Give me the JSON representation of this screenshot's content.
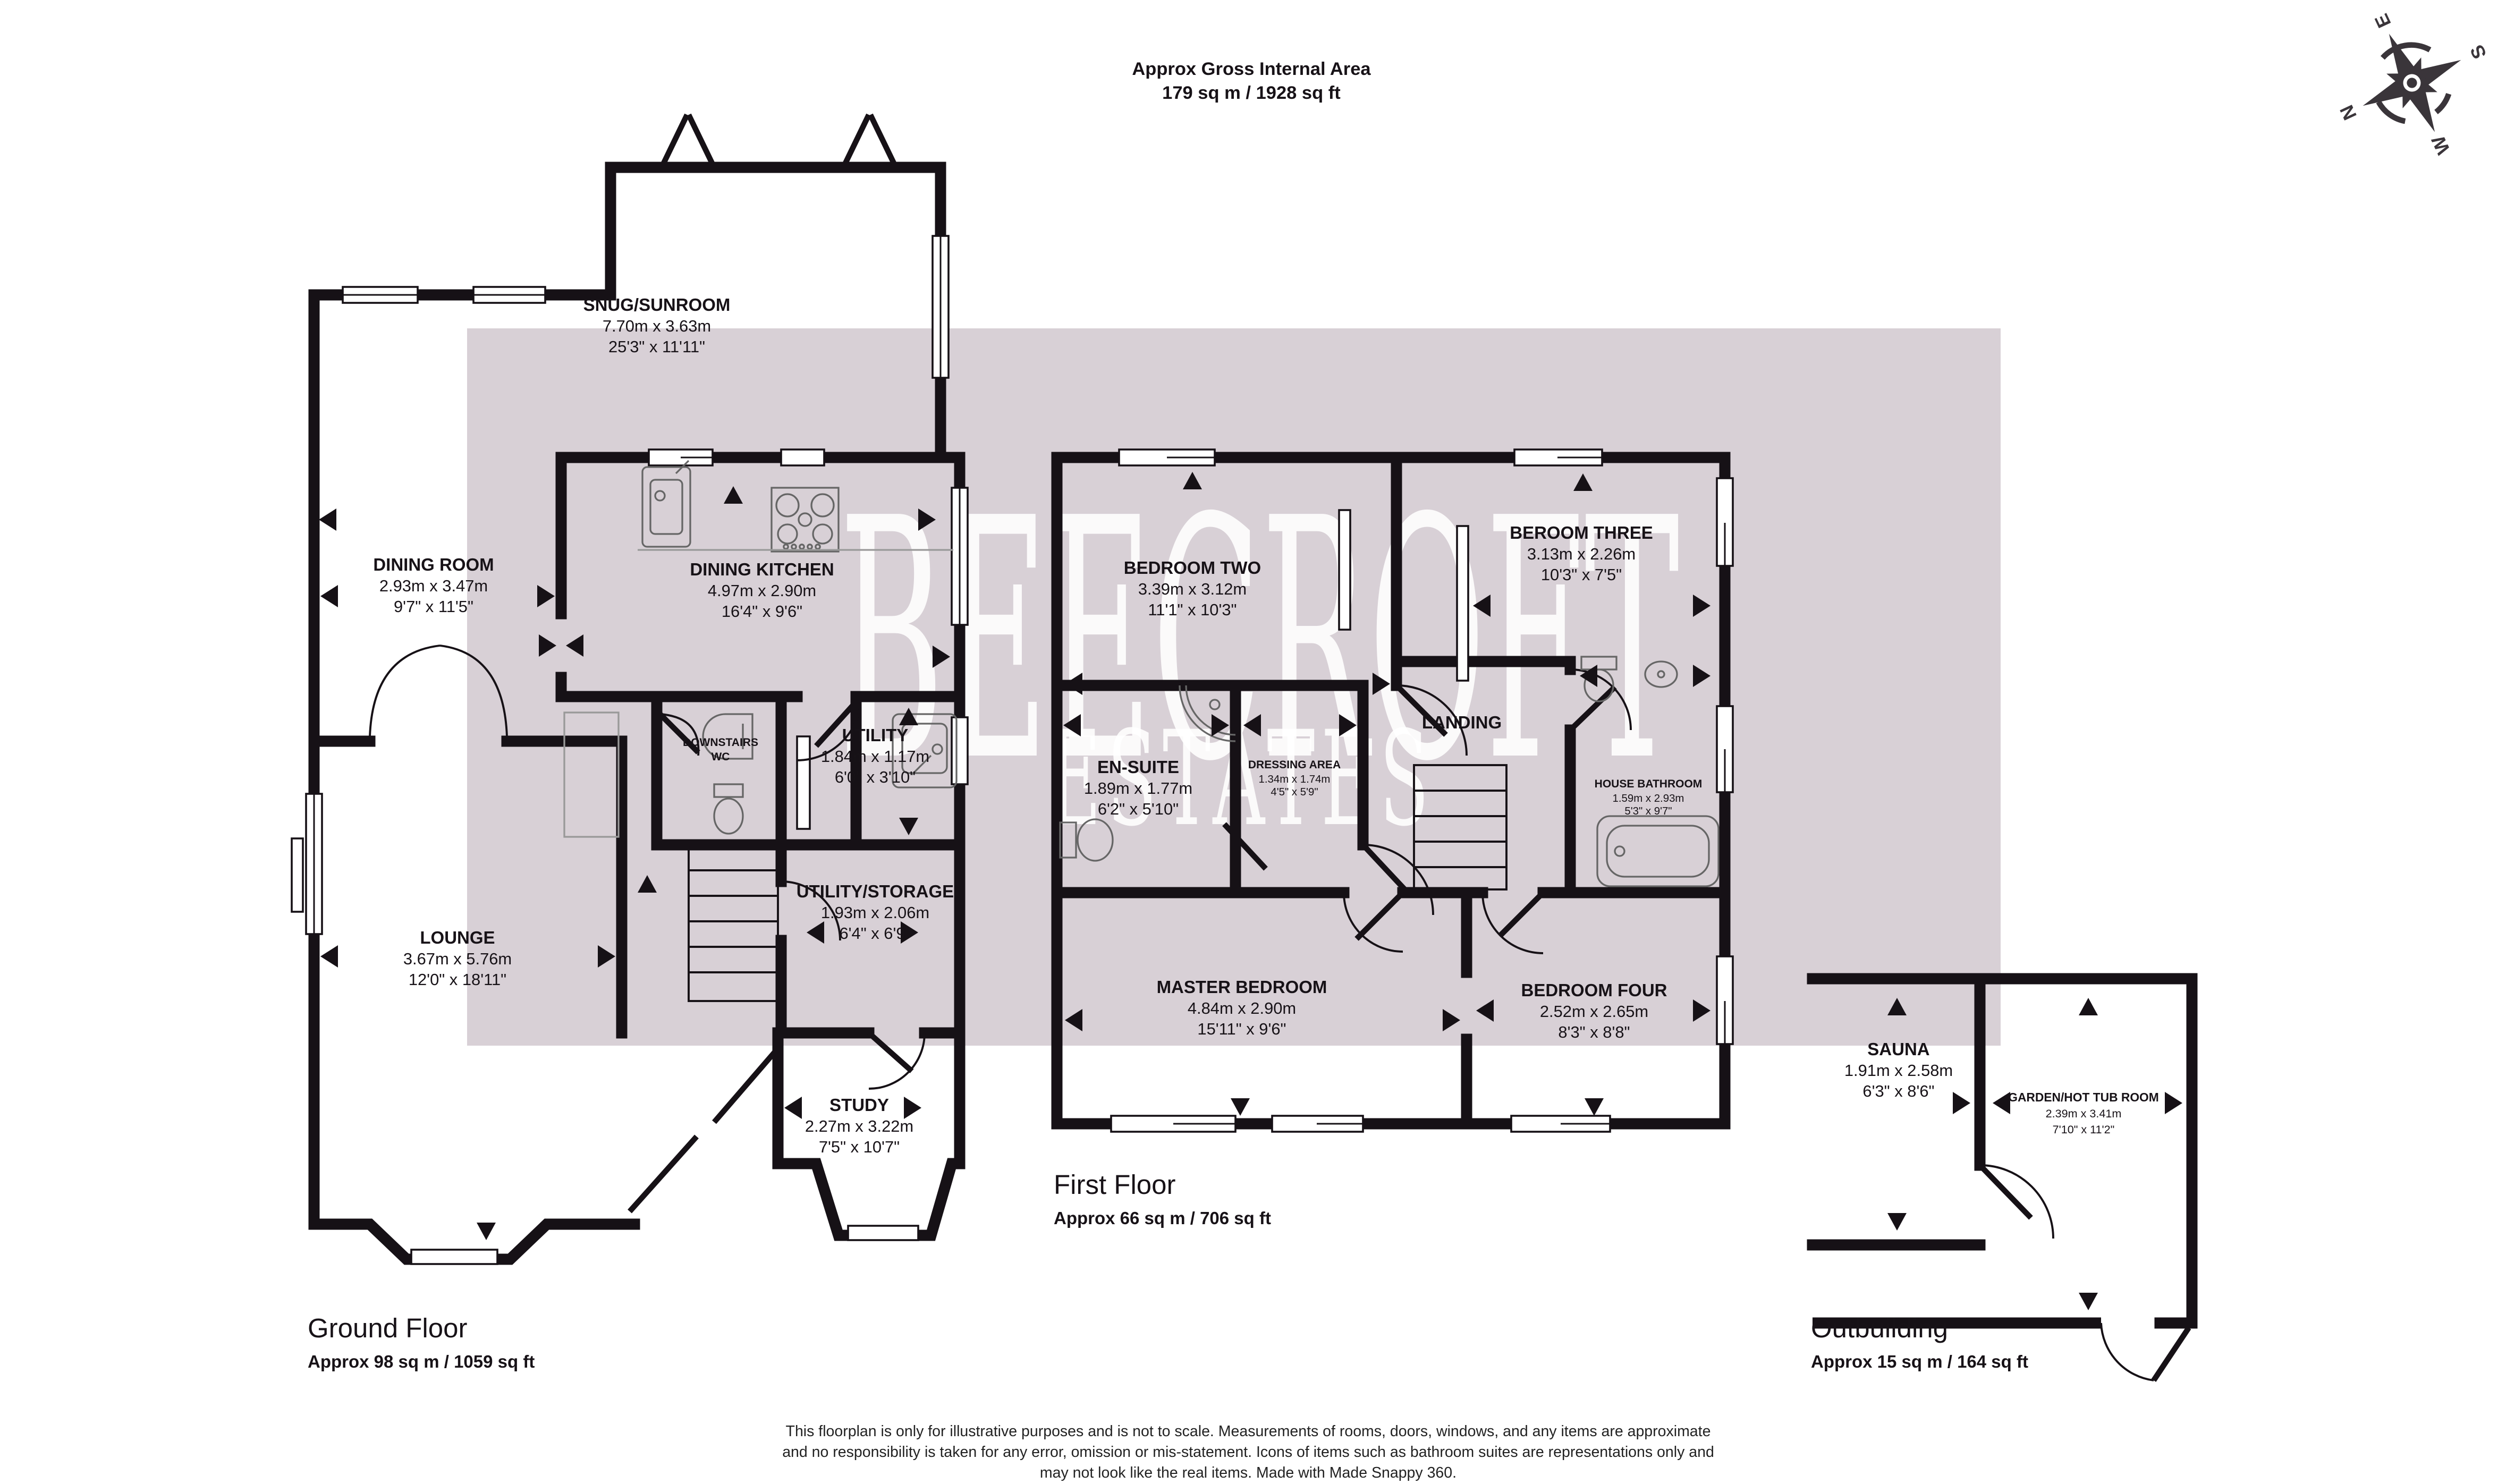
{
  "header": {
    "title": "Approx Gross Internal Area",
    "area": "179 sq m / 1928 sq ft"
  },
  "watermark": {
    "line1": "BEECROFT",
    "line2": "ESTATES"
  },
  "compass": {
    "n": "N",
    "e": "E",
    "s": "S",
    "w": "W"
  },
  "colors": {
    "wall": "#161116",
    "band": "#d8d0d6",
    "fixture": "#666666"
  },
  "floors": {
    "ground": {
      "title": "Ground Floor",
      "area": "Approx 98 sq m / 1059 sq ft",
      "rooms": {
        "snug": {
          "name": "SNUG/SUNROOM",
          "metric": "7.70m x 3.63m",
          "imperial": "25'3\" x 11'11\""
        },
        "dining_room": {
          "name": "DINING ROOM",
          "metric": "2.93m x 3.47m",
          "imperial": "9'7\" x 11'5\""
        },
        "dining_kitchen": {
          "name": "DINING KITCHEN",
          "metric": "4.97m x 2.90m",
          "imperial": "16'4\" x 9'6\""
        },
        "downstairs_wc": {
          "line1": "DOWNSTAIRS",
          "line2": "WC"
        },
        "utility": {
          "name": "UTILITY",
          "metric": "1.84m x 1.17m",
          "imperial": "6'0\" x 3'10\""
        },
        "utility_storage": {
          "name": "UTILITY/STORAGE",
          "metric": "1.93m x 2.06m",
          "imperial": "6'4\" x 6'9\""
        },
        "lounge": {
          "name": "LOUNGE",
          "metric": "3.67m x 5.76m",
          "imperial": "12'0\" x 18'11\""
        },
        "study": {
          "name": "STUDY",
          "metric": "2.27m x 3.22m",
          "imperial": "7'5\" x 10'7\""
        }
      }
    },
    "first": {
      "title": "First Floor",
      "area": "Approx 66 sq m / 706 sq ft",
      "rooms": {
        "bedroom_two": {
          "name": "BEDROOM TWO",
          "metric": "3.39m x 3.12m",
          "imperial": "11'1\" x 10'3\""
        },
        "bedroom_three": {
          "name": "BEROOM THREE",
          "metric": "3.13m x 2.26m",
          "imperial": "10'3\" x 7'5\""
        },
        "en_suite": {
          "name": "EN-SUITE",
          "metric": "1.89m x 1.77m",
          "imperial": "6'2\" x 5'10\""
        },
        "dressing_area": {
          "name": "DRESSING AREA",
          "metric": "1.34m x 1.74m",
          "imperial": "4'5\" x 5'9\""
        },
        "landing": {
          "name": "LANDING"
        },
        "house_bathroom": {
          "name": "HOUSE BATHROOM",
          "metric": "1.59m x 2.93m",
          "imperial": "5'3\" x 9'7\""
        },
        "master_bedroom": {
          "name": "MASTER BEDROOM",
          "metric": "4.84m x 2.90m",
          "imperial": "15'11\" x 9'6\""
        },
        "bedroom_four": {
          "name": "BEDROOM FOUR",
          "metric": "2.52m x 2.65m",
          "imperial": "8'3\" x 8'8\""
        }
      }
    },
    "outbuilding": {
      "title": "Outbuilding",
      "area": "Approx 15 sq m / 164 sq ft",
      "rooms": {
        "sauna": {
          "name": "SAUNA",
          "metric": "1.91m x 2.58m",
          "imperial": "6'3\" x 8'6\""
        },
        "garden_hot_tub": {
          "name": "GARDEN/HOT TUB ROOM",
          "metric": "2.39m x 3.41m",
          "imperial": "7'10\" x 11'2\""
        }
      }
    }
  },
  "disclaimer": {
    "line1": "This floorplan is only for illustrative purposes and is not to scale. Measurements of rooms, doors, windows, and any items are approximate",
    "line2": "and no responsibility is taken for any error, omission or mis-statement. Icons of items such as bathroom suites are representations only and",
    "line3": "may not look like the real items. Made with Made Snappy 360."
  }
}
